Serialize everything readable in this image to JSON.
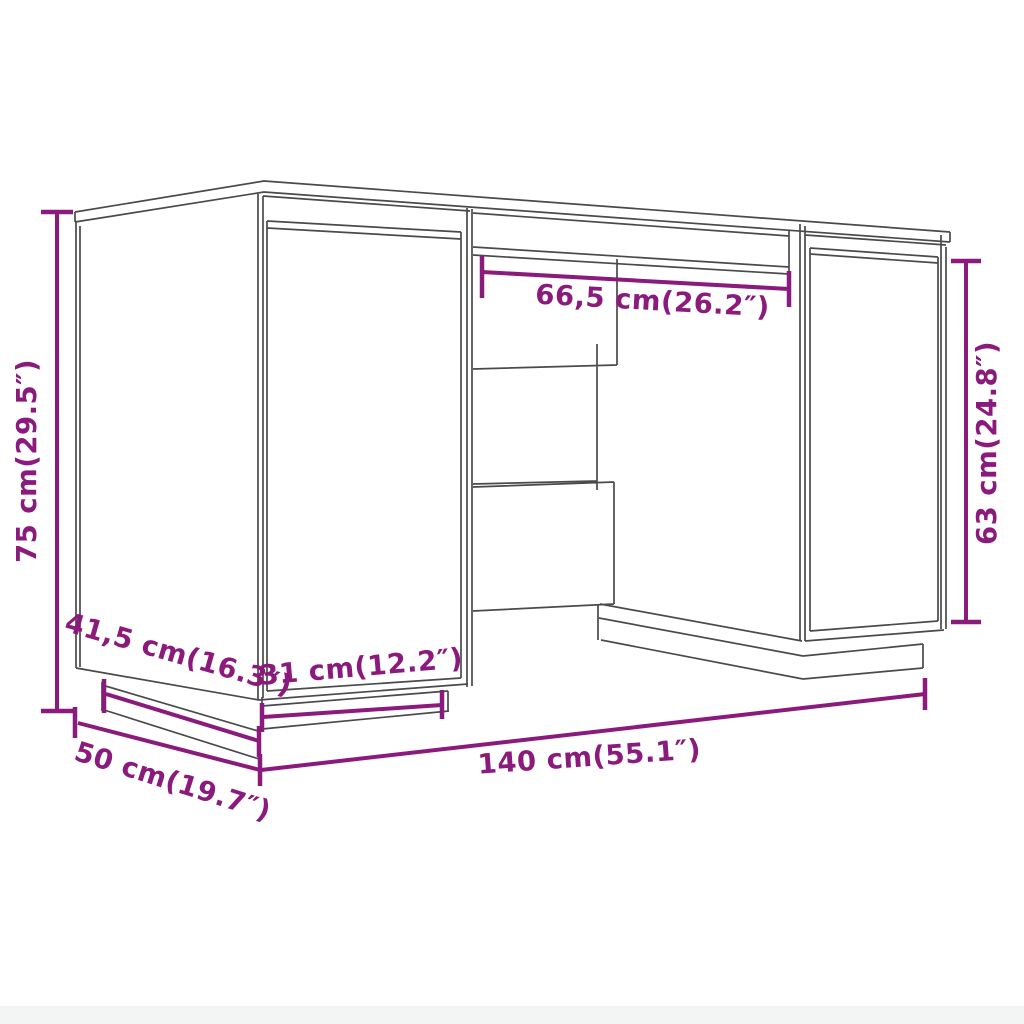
{
  "diagram": {
    "type": "product-dimension-drawing",
    "subject": "desk with two cabinets and center drawer",
    "colors": {
      "dimension_accent": "#8B1A7D",
      "line_art": "#4a4a4a",
      "background": "#ffffff"
    },
    "dimensions": {
      "overall_height": {
        "label": "75 cm(29.5″)",
        "value_cm": "75"
      },
      "center_drawer_width": {
        "label": "66,5 cm(26.2″)",
        "value_cm": "66,5"
      },
      "cabinet_door_height": {
        "label": "63 cm(24.8″)",
        "value_cm": "63"
      },
      "base_depth": {
        "label": "41,5 cm(16.3″)",
        "value_cm": "41,5"
      },
      "cabinet_width": {
        "label": "31 cm(12.2″)",
        "value_cm": "31"
      },
      "overall_depth": {
        "label": "50 cm(19.7″)",
        "value_cm": "50"
      },
      "overall_width": {
        "label": "140 cm(55.1″)",
        "value_cm": "140"
      }
    }
  }
}
